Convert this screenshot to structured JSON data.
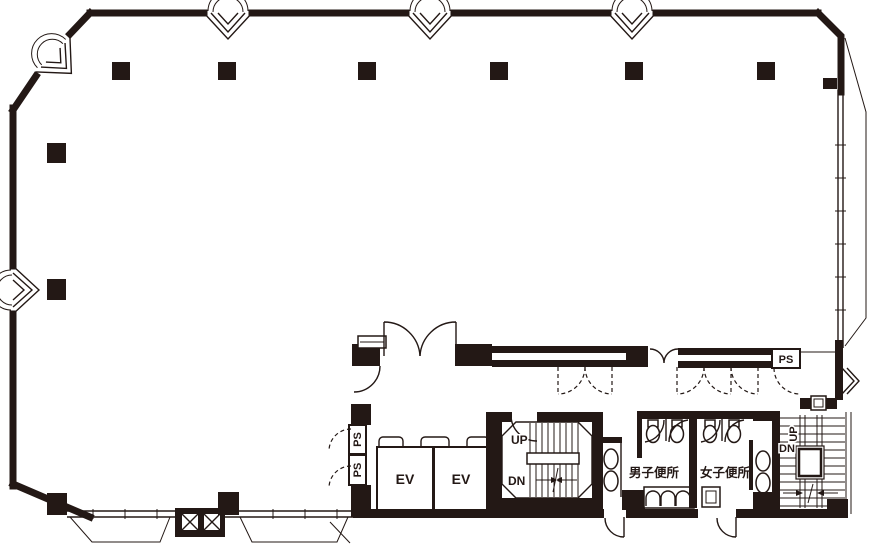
{
  "document": {
    "type": "building-floor-plan",
    "colors": {
      "ink": "#231815",
      "background": "#ffffff"
    }
  },
  "plan": {
    "elevators": [
      {
        "label": "EV"
      },
      {
        "label": "EV"
      }
    ],
    "pipe_shafts": [
      {
        "label": "PS"
      },
      {
        "label": "PS"
      },
      {
        "label": "PS"
      }
    ],
    "main_stair": {
      "up": "UP",
      "down": "DN"
    },
    "fire_stair": {
      "up": "UP",
      "down": "DN"
    },
    "toilets": {
      "mens": "男子便所",
      "womens": "女子便所"
    }
  }
}
